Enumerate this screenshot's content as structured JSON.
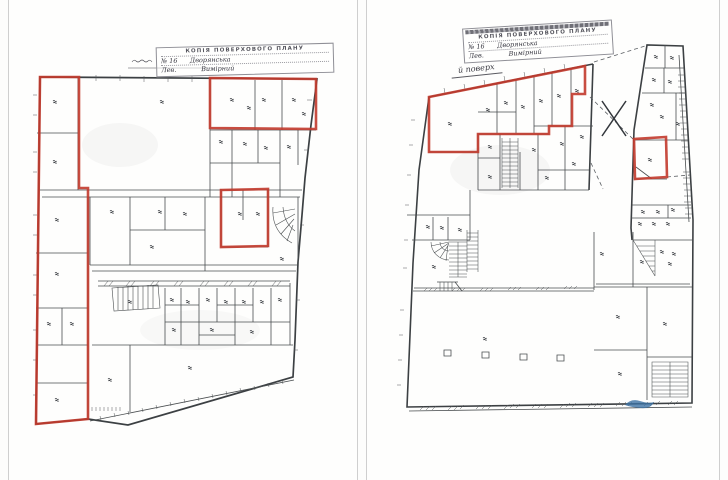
{
  "meta": {
    "background": "#fdfdfc",
    "page_edge_color": "#cfcfcf",
    "ink_color": "#3c4043",
    "red_color": "#c23a2c",
    "blue_color": "#3c72a4"
  },
  "left_plan": {
    "stamp": {
      "header": "КОПІЯ ПОВЕРХОВОГО ПЛАНУ",
      "line1": "№ 16      Дворянська",
      "line2": "Лев.            Вимірний"
    },
    "red_outlines": [
      [
        [
          40,
          77
        ],
        [
          79,
          77
        ],
        [
          79,
          188
        ],
        [
          88,
          188
        ],
        [
          88,
          419
        ],
        [
          36,
          424
        ]
      ],
      [
        [
          210,
          78
        ],
        [
          316,
          79
        ],
        [
          316,
          129
        ],
        [
          210,
          128
        ]
      ],
      [
        [
          221,
          190
        ],
        [
          268,
          189
        ],
        [
          268,
          246
        ],
        [
          221,
          247
        ]
      ]
    ],
    "room_label_marks": [
      [
        53,
        100
      ],
      [
        53,
        160
      ],
      [
        55,
        218
      ],
      [
        55,
        272
      ],
      [
        47,
        322
      ],
      [
        70,
        322
      ],
      [
        55,
        398
      ],
      [
        160,
        100
      ],
      [
        230,
        98
      ],
      [
        247,
        106
      ],
      [
        262,
        98
      ],
      [
        292,
        98
      ],
      [
        302,
        112
      ],
      [
        219,
        140
      ],
      [
        243,
        142
      ],
      [
        264,
        146
      ],
      [
        287,
        145
      ],
      [
        110,
        210
      ],
      [
        158,
        210
      ],
      [
        183,
        212
      ],
      [
        150,
        245
      ],
      [
        238,
        212
      ],
      [
        256,
        212
      ],
      [
        280,
        257
      ],
      [
        128,
        300
      ],
      [
        170,
        298
      ],
      [
        186,
        300
      ],
      [
        206,
        298
      ],
      [
        224,
        300
      ],
      [
        242,
        300
      ],
      [
        260,
        300
      ],
      [
        278,
        298
      ],
      [
        172,
        328
      ],
      [
        210,
        328
      ],
      [
        250,
        330
      ],
      [
        188,
        366
      ],
      [
        108,
        378
      ]
    ]
  },
  "right_plan": {
    "stamp": {
      "header": "КОПІЯ ПОВЕРХОВОГО ПЛАНУ",
      "line1": "№ 16      Дворянська",
      "line2": "Лев.            Вимірний"
    },
    "floor_note": "й поверх",
    "x_mark": "X",
    "red_outlines": [
      [
        [
          429,
          97
        ],
        [
          585,
          66
        ],
        [
          585,
          94
        ],
        [
          572,
          94
        ],
        [
          572,
          126
        ],
        [
          549,
          126
        ],
        [
          549,
          134
        ],
        [
          478,
          134
        ],
        [
          478,
          152
        ],
        [
          429,
          152
        ]
      ],
      [
        [
          634,
          139
        ],
        [
          666,
          137
        ],
        [
          667,
          177
        ],
        [
          635,
          179
        ]
      ]
    ],
    "room_label_marks": [
      [
        654,
        55
      ],
      [
        670,
        56
      ],
      [
        652,
        78
      ],
      [
        668,
        80
      ],
      [
        650,
        103
      ],
      [
        660,
        115
      ],
      [
        676,
        122
      ],
      [
        648,
        158
      ],
      [
        641,
        210
      ],
      [
        656,
        210
      ],
      [
        671,
        208
      ],
      [
        638,
        222
      ],
      [
        652,
        222
      ],
      [
        666,
        222
      ],
      [
        660,
        250
      ],
      [
        672,
        252
      ],
      [
        640,
        260
      ],
      [
        448,
        122
      ],
      [
        486,
        108
      ],
      [
        504,
        101
      ],
      [
        521,
        105
      ],
      [
        539,
        99
      ],
      [
        557,
        94
      ],
      [
        575,
        89
      ],
      [
        488,
        145
      ],
      [
        532,
        148
      ],
      [
        560,
        142
      ],
      [
        580,
        135
      ],
      [
        488,
        175
      ],
      [
        545,
        176
      ],
      [
        572,
        162
      ],
      [
        426,
        225
      ],
      [
        440,
        226
      ],
      [
        458,
        228
      ],
      [
        432,
        265
      ],
      [
        483,
        337
      ],
      [
        616,
        315
      ],
      [
        663,
        322
      ],
      [
        618,
        372
      ],
      [
        600,
        252
      ],
      [
        668,
        262
      ]
    ]
  }
}
